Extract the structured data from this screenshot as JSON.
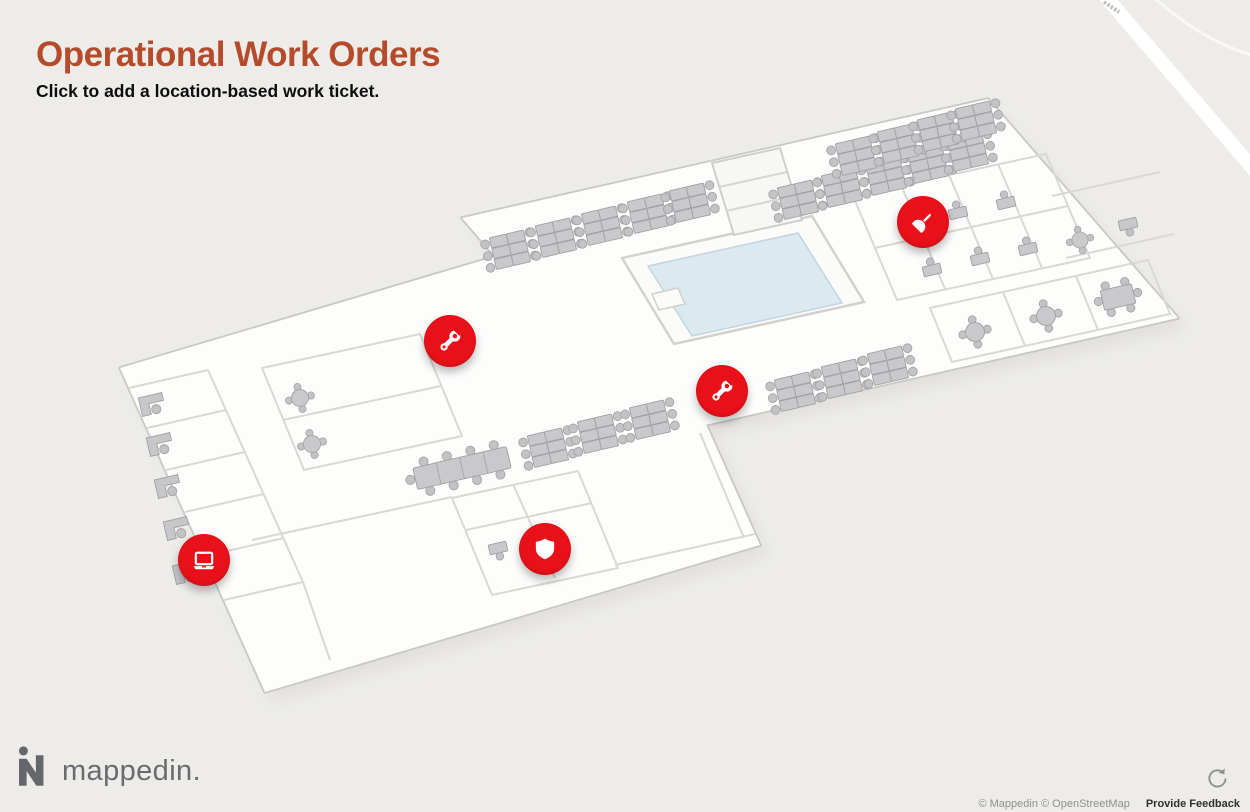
{
  "header": {
    "title": "Operational Work Orders",
    "subtitle": "Click to add a location-based work ticket."
  },
  "map": {
    "work_order_markers": [
      {
        "icon": "wrench-icon"
      },
      {
        "icon": "wrench-icon"
      },
      {
        "icon": "plunger-icon"
      },
      {
        "icon": "laptop-icon"
      },
      {
        "icon": "shield-icon"
      }
    ],
    "marker_color": "#e8111a",
    "pool_color": "#dbe9f1"
  },
  "footer": {
    "logo_text": "mappedin.",
    "attribution": "© Mappedin © OpenStreetMap",
    "feedback_label": "Provide Feedback",
    "compass_icon": "reset-rotation-icon"
  },
  "colors": {
    "background": "#edece9",
    "title": "#b54b2b",
    "subtitle": "#0d0d0d"
  }
}
